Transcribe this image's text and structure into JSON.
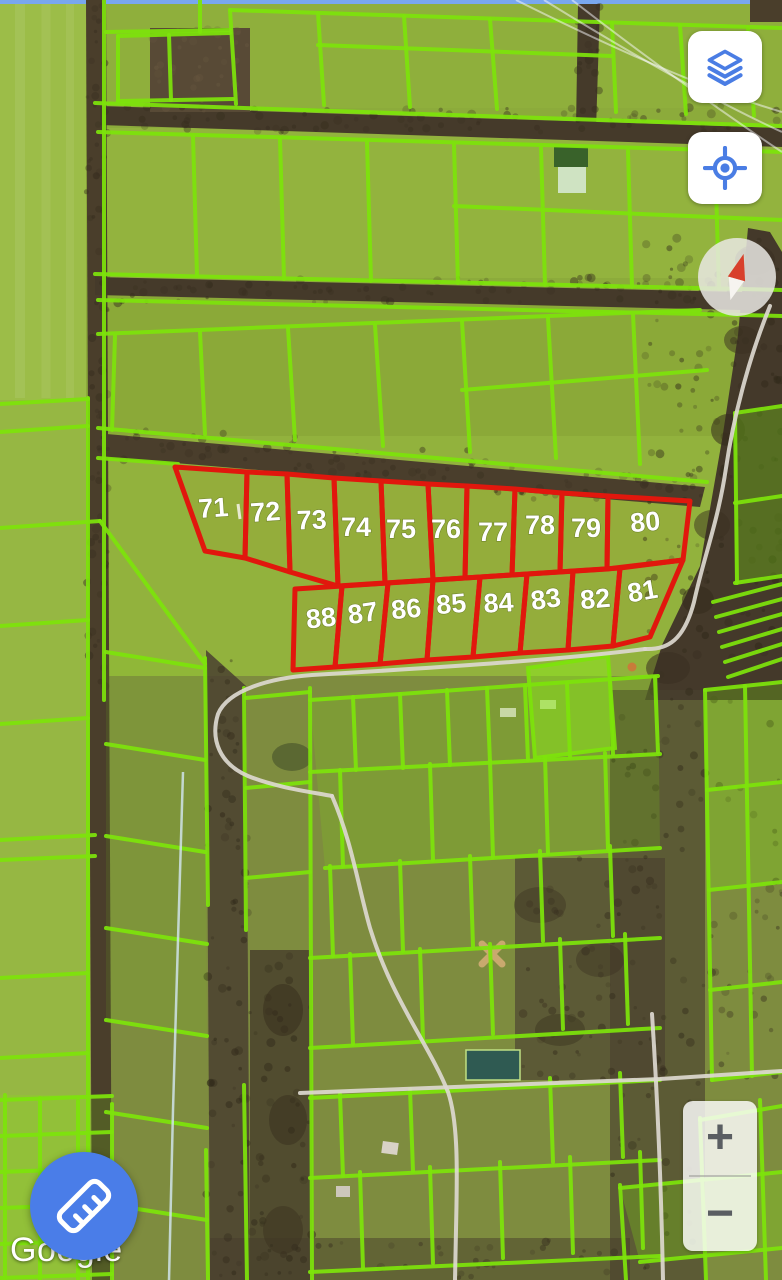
{
  "attribution": {
    "logo_text": "Google"
  },
  "controls": {
    "layers_button": {
      "icon": "layers-icon"
    },
    "locate_button": {
      "icon": "locate-icon"
    },
    "compass_button": {
      "icon": "compass-needle-icon"
    },
    "zoom_in_label": "+",
    "zoom_out_label": "−",
    "measure_button": {
      "icon": "ruler-icon"
    }
  },
  "colors": {
    "control_icon_blue": "#4a7de4",
    "measure_fab_blue": "#4a7de8",
    "parcel_outline_red": "#e1170d",
    "parcel_number_white": "#ffffff",
    "cadastre_green": "#7de30b",
    "zoom_glyph_gray": "#5a5e62"
  },
  "surveyed_parcels": [
    {
      "number": "71",
      "points": "175,467 247,472 245,558 205,551",
      "label": {
        "x": 214,
        "y": 517,
        "rotate": -4
      }
    },
    {
      "number": "72",
      "points": "247,472 287,474 290,572 245,558",
      "label": {
        "x": 266,
        "y": 521,
        "rotate": -4
      }
    },
    {
      "number": "73",
      "points": "287,474 334,478 338,586 290,572",
      "label": {
        "x": 312,
        "y": 529,
        "rotate": -2
      }
    },
    {
      "number": "74",
      "points": "334,478 381,481 385,583 338,586",
      "label": {
        "x": 356,
        "y": 536,
        "rotate": 0
      }
    },
    {
      "number": "75",
      "points": "381,481 428,484 433,580 385,583",
      "label": {
        "x": 401,
        "y": 538,
        "rotate": 0
      }
    },
    {
      "number": "76",
      "points": "428,484 467,486 465,578 433,580",
      "label": {
        "x": 446,
        "y": 538,
        "rotate": 0
      }
    },
    {
      "number": "77",
      "points": "467,486 515,489 512,575 465,578",
      "label": {
        "x": 493,
        "y": 541,
        "rotate": 0
      }
    },
    {
      "number": "78",
      "points": "515,489 562,493 560,572 512,575",
      "label": {
        "x": 540,
        "y": 534,
        "rotate": 0
      }
    },
    {
      "number": "79",
      "points": "562,493 608,496 607,569 560,572",
      "label": {
        "x": 586,
        "y": 537,
        "rotate": 0
      }
    },
    {
      "number": "80",
      "points": "608,496 690,501 683,560 607,569",
      "label": {
        "x": 646,
        "y": 531,
        "rotate": -5
      }
    },
    {
      "number": "81",
      "points": "620,568 683,560 650,637 613,646",
      "label": {
        "x": 644,
        "y": 600,
        "rotate": -10
      }
    },
    {
      "number": "82",
      "points": "573,571 620,568 613,646 568,650",
      "label": {
        "x": 596,
        "y": 608,
        "rotate": -5
      }
    },
    {
      "number": "83",
      "points": "527,574 573,571 568,650 520,653",
      "label": {
        "x": 547,
        "y": 608,
        "rotate": -8
      }
    },
    {
      "number": "84",
      "points": "480,577 527,574 520,653 473,657",
      "label": {
        "x": 499,
        "y": 612,
        "rotate": -3
      }
    },
    {
      "number": "85",
      "points": "433,580 480,577 473,657 427,660",
      "label": {
        "x": 452,
        "y": 613,
        "rotate": -5
      }
    },
    {
      "number": "86",
      "points": "388,583 433,580 427,660 380,664",
      "label": {
        "x": 407,
        "y": 618,
        "rotate": -5
      }
    },
    {
      "number": "87",
      "points": "342,586 388,583 380,664 335,667",
      "label": {
        "x": 364,
        "y": 622,
        "rotate": -8
      }
    },
    {
      "number": "88",
      "points": "295,589 342,586 335,667 293,670",
      "label": {
        "x": 322,
        "y": 627,
        "rotate": -6
      }
    }
  ]
}
